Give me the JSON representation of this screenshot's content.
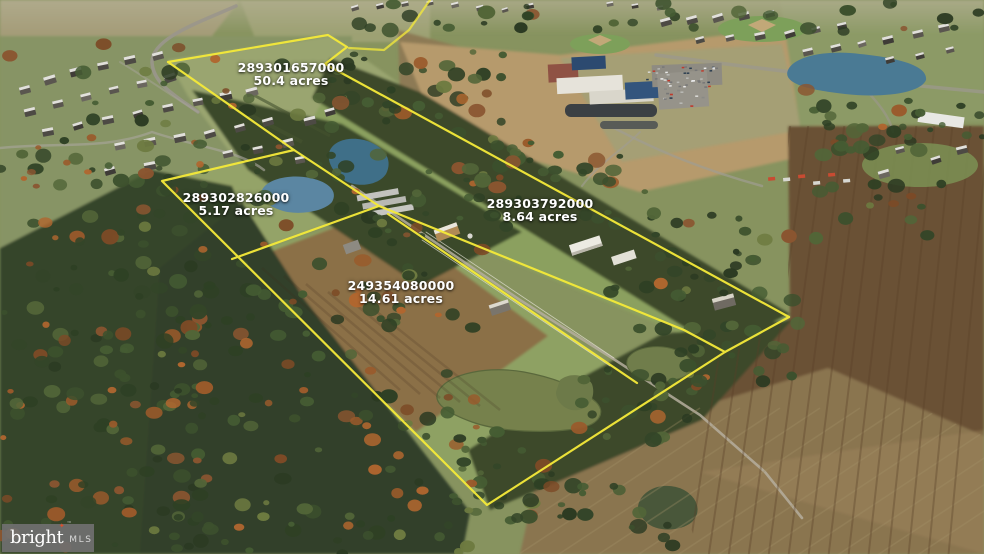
{
  "parcels": [
    {
      "id": "289301657000",
      "acres": "50.4 acres"
    },
    {
      "id": "289302826000",
      "acres": "5.17 acres"
    },
    {
      "id": "289303792000",
      "acres": "8.64 acres"
    },
    {
      "id": "249354080000",
      "acres": "14.61 acres"
    }
  ],
  "watermark": {
    "brand": "bright",
    "mls": "MLS",
    "star": "✦",
    "tm": "™"
  },
  "colors": {
    "boundary": "#f5ea39",
    "label_text": "#ffffff",
    "watermark_bg": "rgba(112,112,112,0.92)",
    "brand_star": "#d8502e"
  }
}
